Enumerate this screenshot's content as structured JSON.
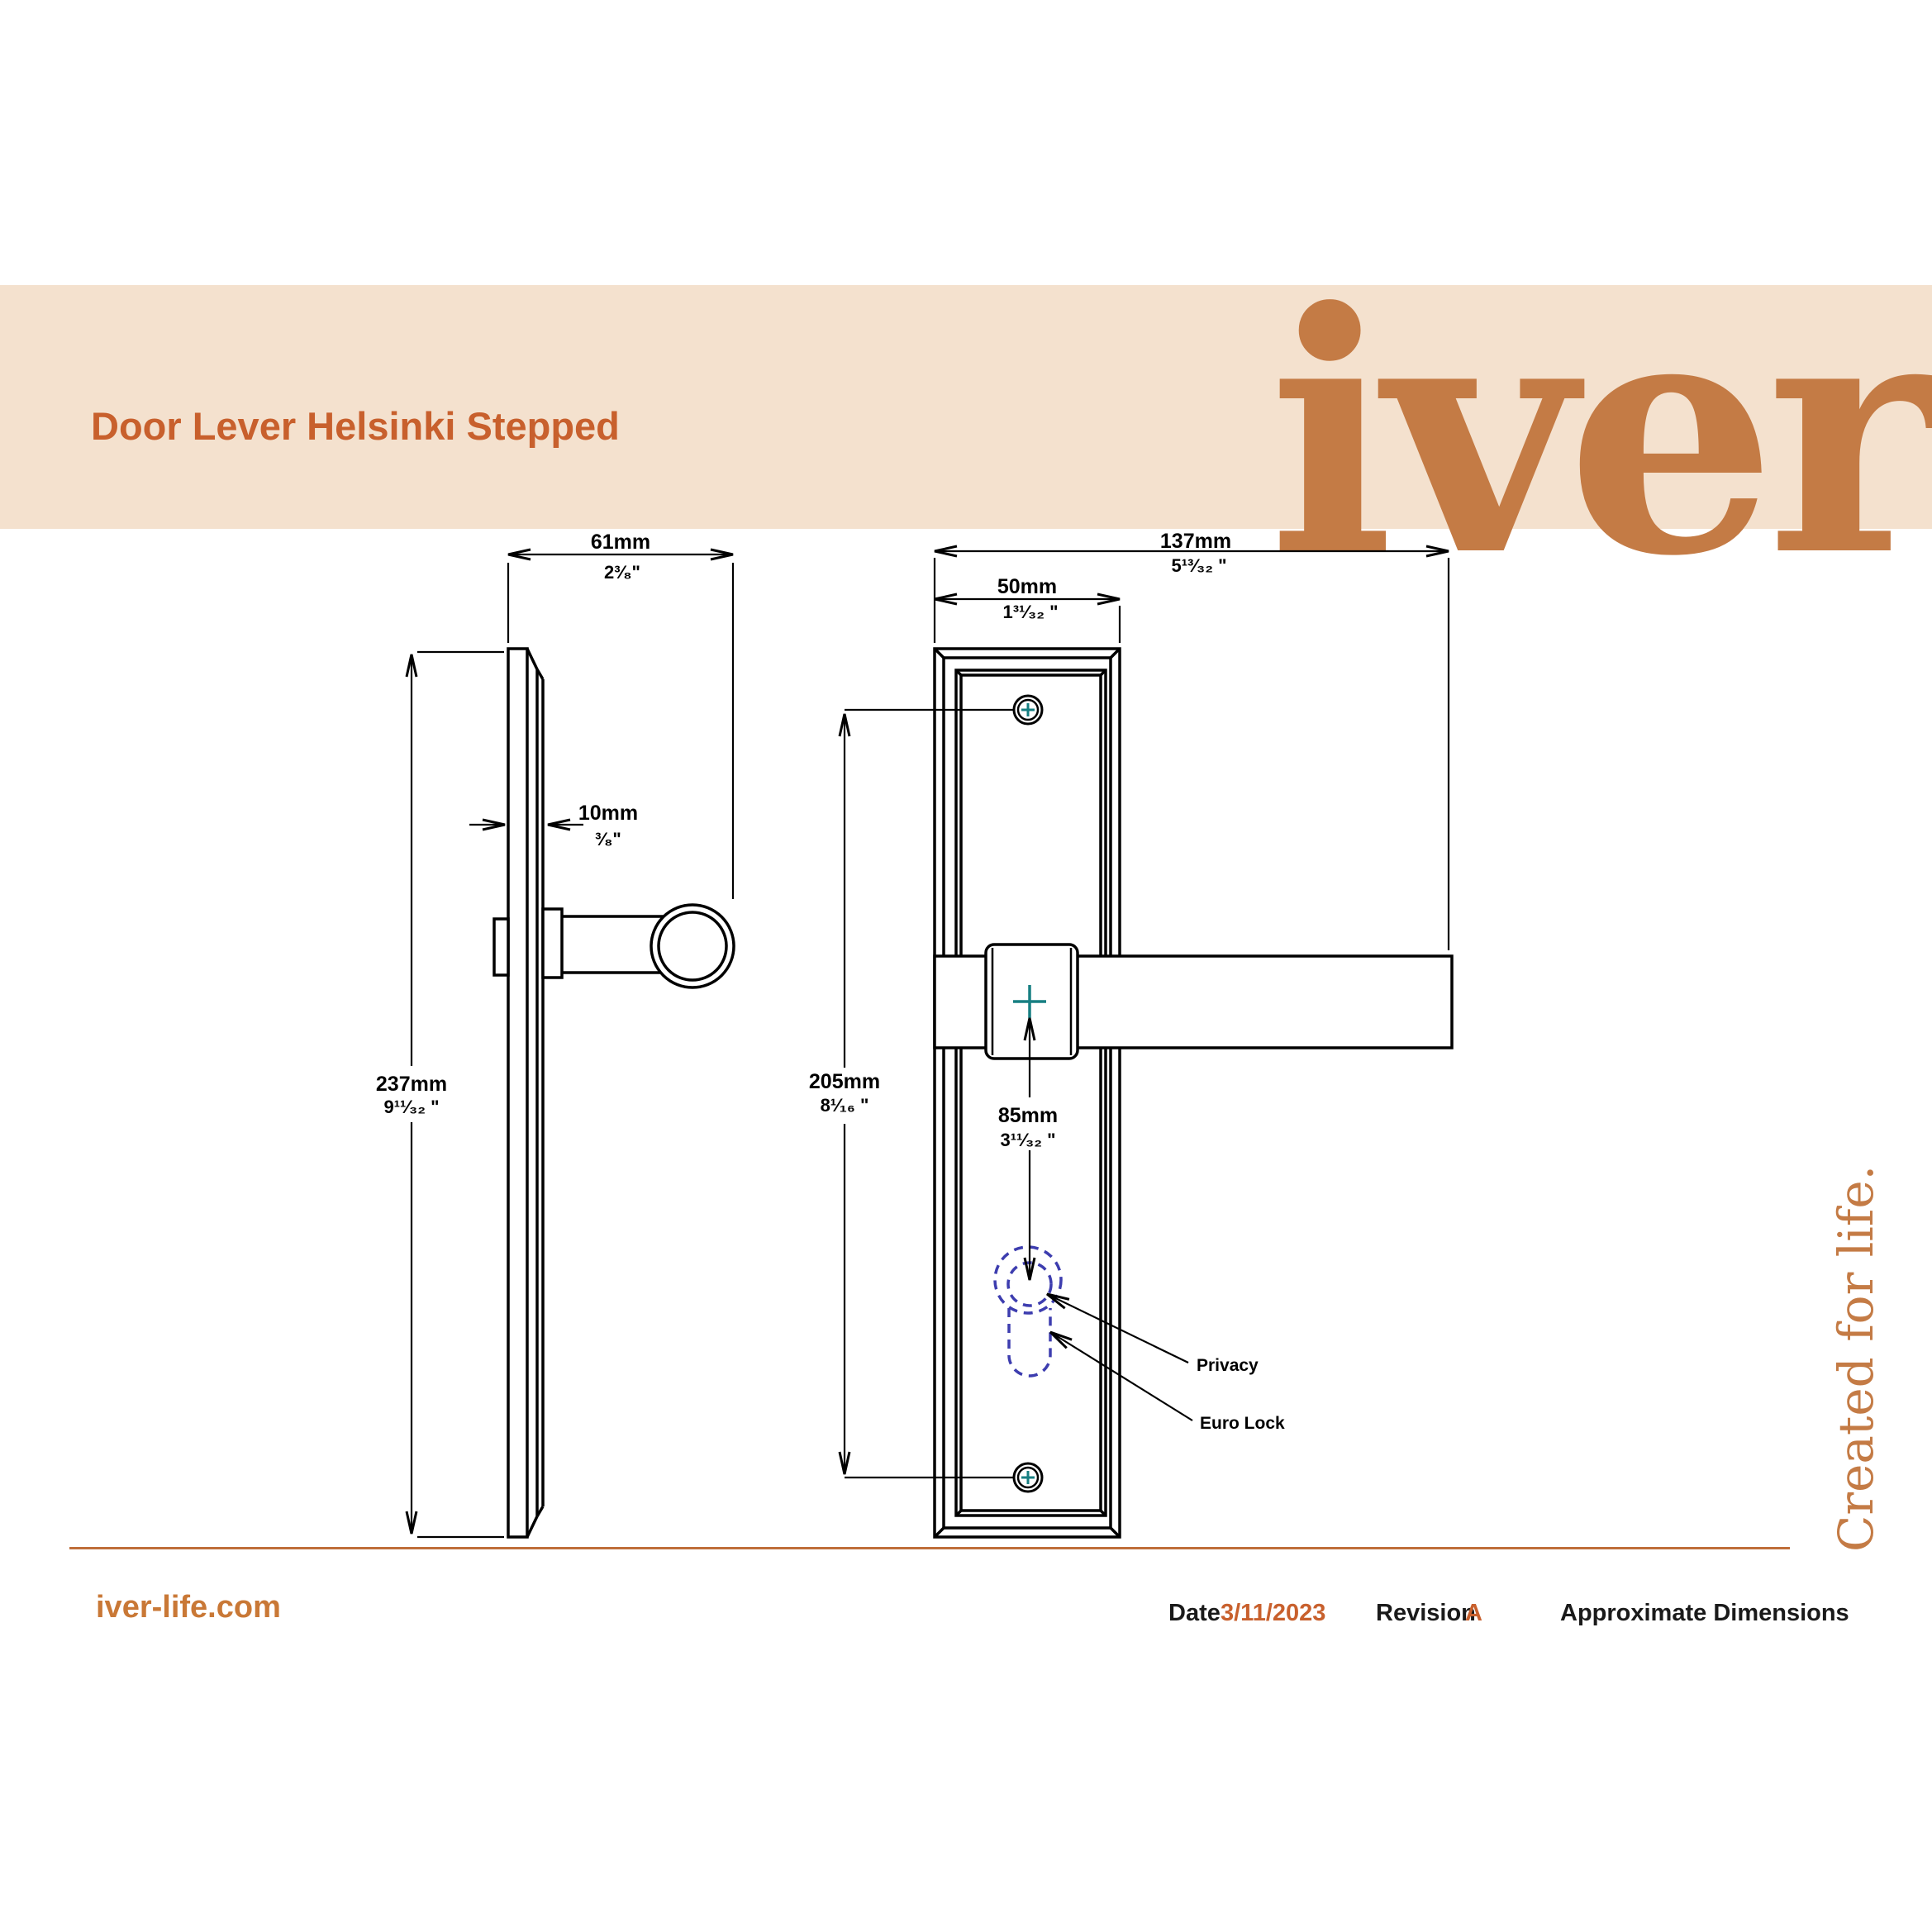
{
  "header": {
    "title": "Door Lever Helsinki Stepped",
    "logo_text": "iver"
  },
  "tagline": "Created for life.",
  "drawing": {
    "dims": {
      "side_width": {
        "mm": "61mm",
        "inch": "2³⁄₈\""
      },
      "plate_thickness": {
        "mm": "10mm",
        "inch": "³⁄₈\""
      },
      "side_height": {
        "mm": "237mm",
        "inch": "9¹¹⁄₃₂ \""
      },
      "total_width": {
        "mm": "137mm",
        "inch": "5¹³⁄₃₂ \""
      },
      "plate_width": {
        "mm": "50mm",
        "inch": "1³¹⁄₃₂ \""
      },
      "screw_spacing": {
        "mm": "205mm",
        "inch": "8¹⁄₁₆ \""
      },
      "centre_to_key": {
        "mm": "85mm",
        "inch": "3¹¹⁄₃₂ \""
      }
    },
    "callouts": {
      "privacy": "Privacy",
      "euro_lock": "Euro Lock"
    }
  },
  "footer": {
    "website": "iver-life.com",
    "date_label": "Date",
    "date_value": "3/11/2023",
    "revision_label": "Revision",
    "revision_value": "A",
    "note": "Approximate Dimensions"
  },
  "colors": {
    "band": "#f4e1ce",
    "title_orange": "#c8602d",
    "logo_orange": "#c47b45",
    "accent_orange": "#c97836",
    "rule_orange": "#bf6e3a",
    "teal": "#177f82",
    "keyhole_blue": "#3d3daf",
    "line_black": "#000000"
  }
}
